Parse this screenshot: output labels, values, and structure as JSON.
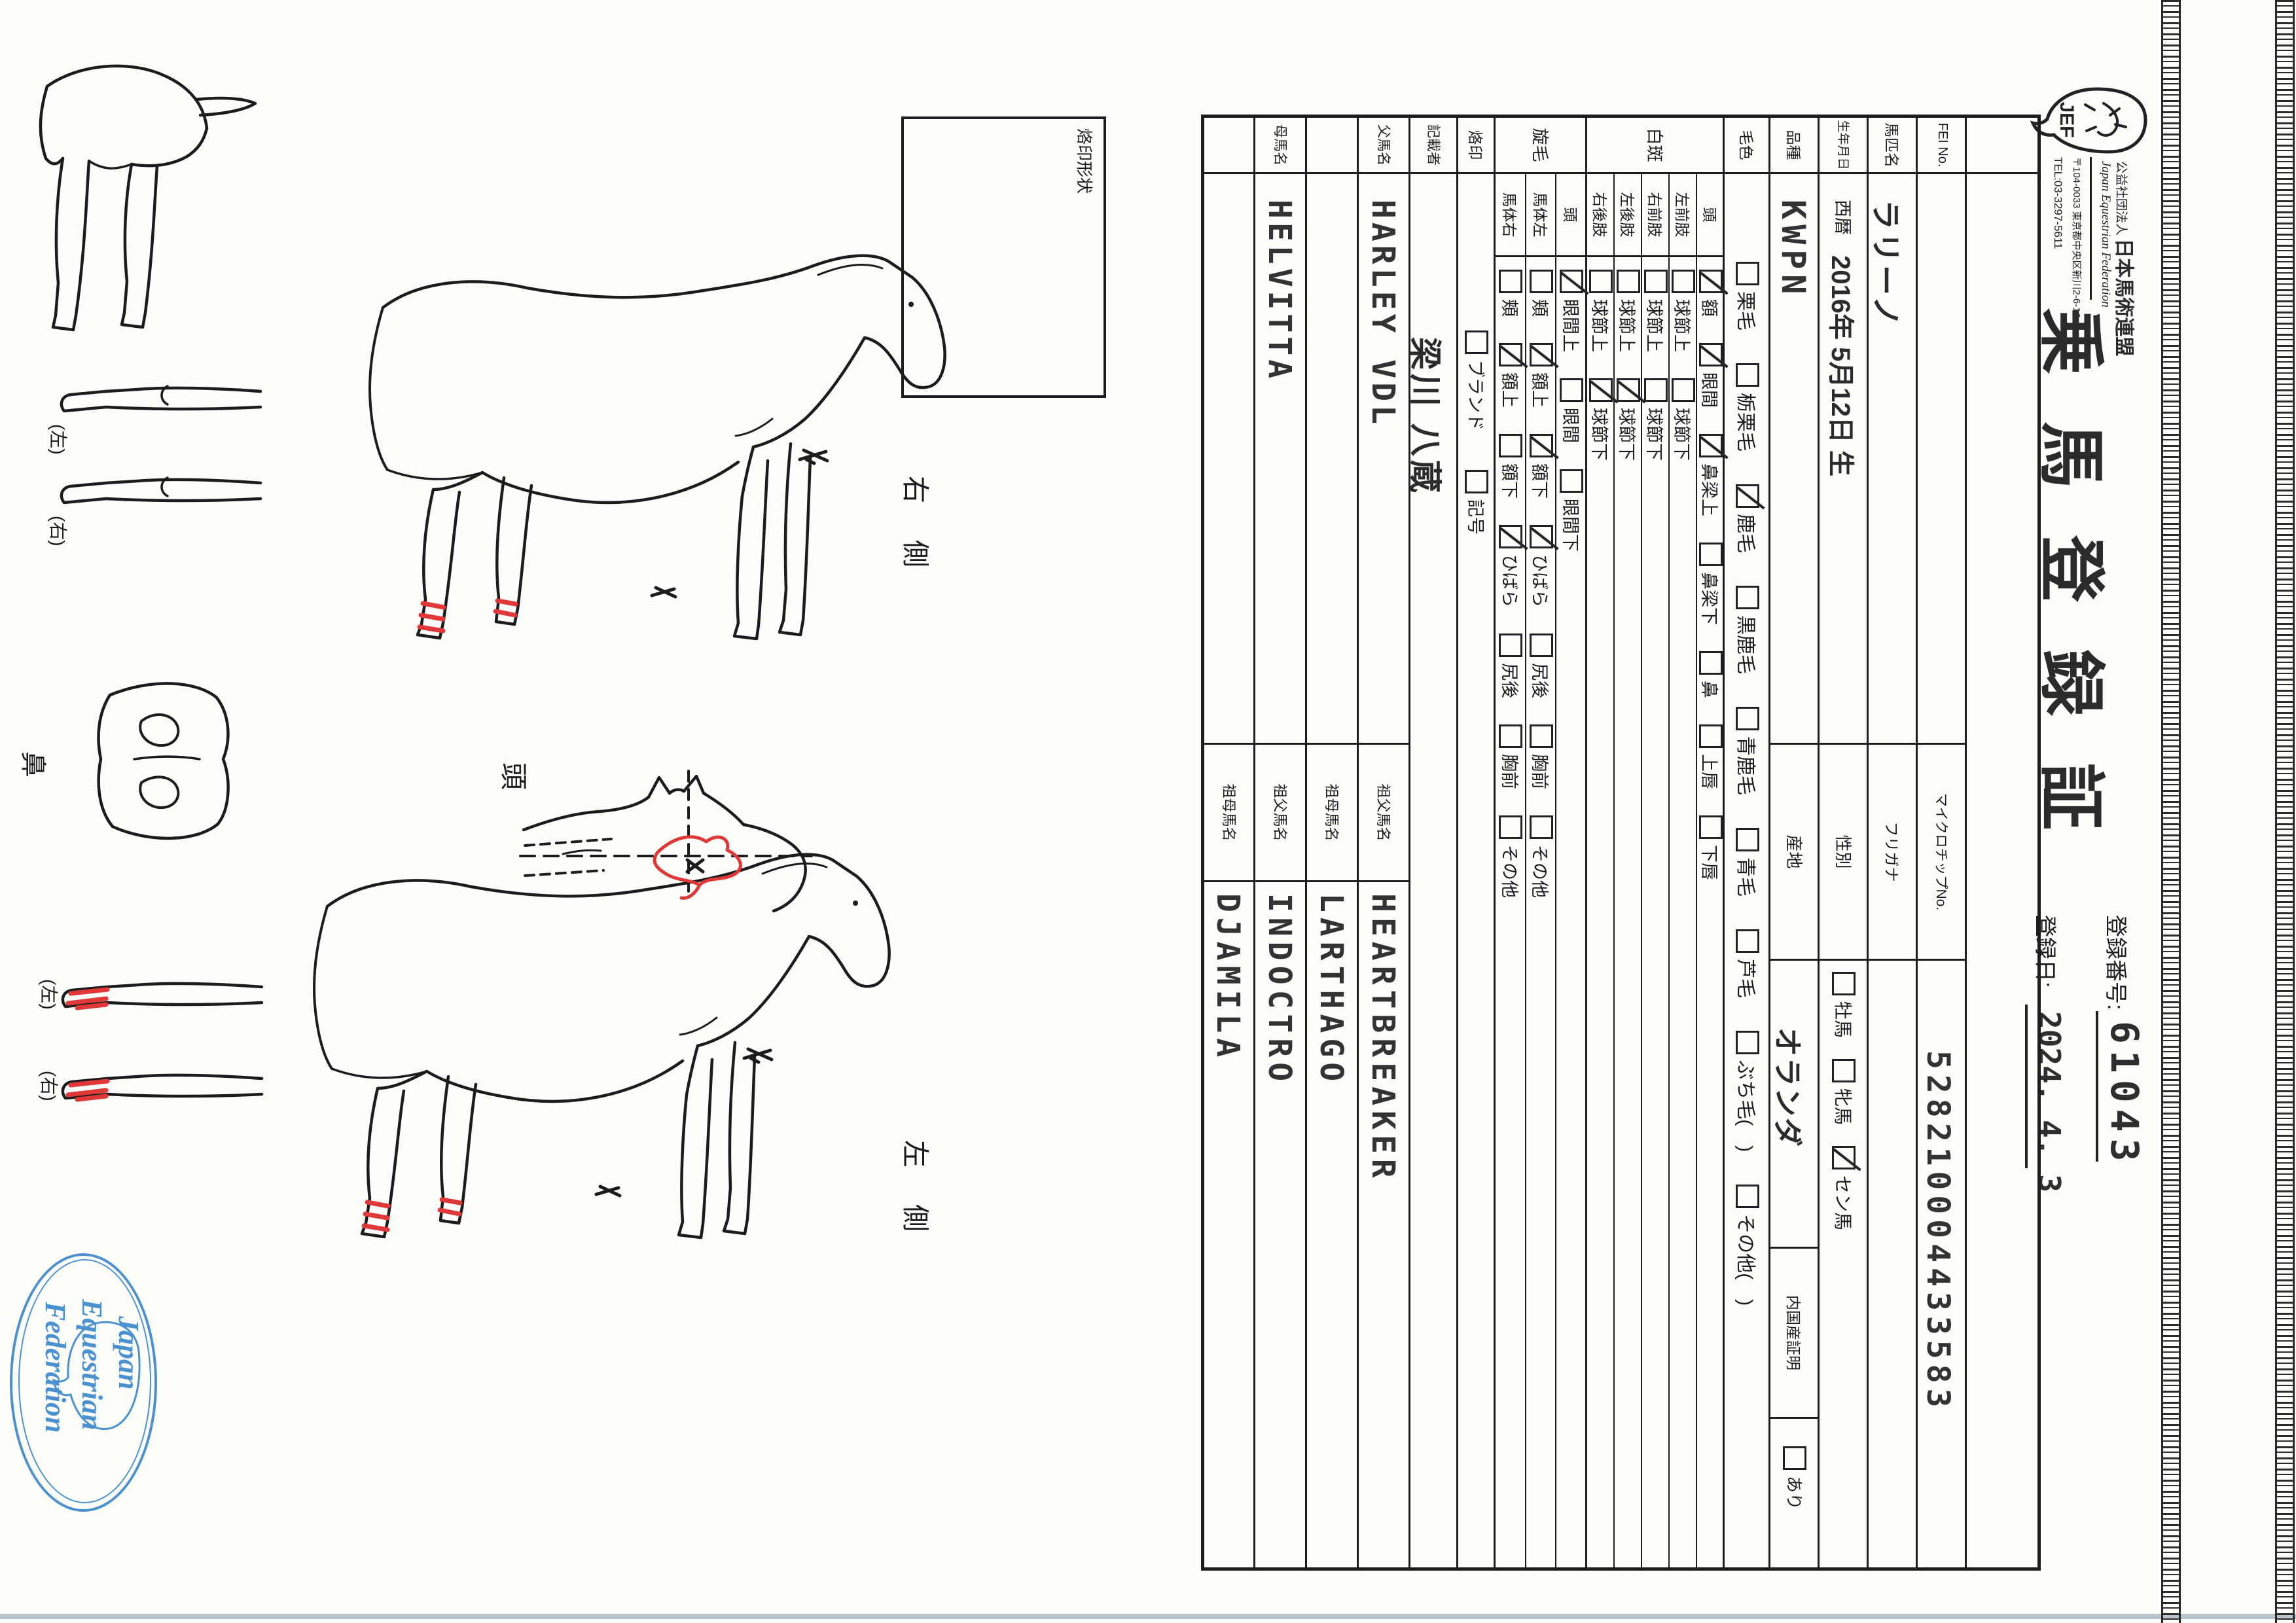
{
  "header": {
    "org_small": "公益社団法人",
    "org_name": "日本馬術連盟",
    "org_en": "Japan Equestrian Federation",
    "address": "〒104-0033 東京都中央区新川2-6-16",
    "tel": "TEL:03-3297-5611",
    "logo_text": "JEF",
    "title": "乗馬登録証",
    "reg_no_label": "登録番号:",
    "reg_no": "61043",
    "reg_date_label": "登録日:",
    "reg_date": "2024. 4. 3"
  },
  "table": {
    "fei_label": "FEI No.",
    "microchip_label": "マイクロチップNo.",
    "microchip": "528210004433583",
    "name_label": "馬匹名",
    "name": "ラリーノ",
    "furigana_label": "フリガナ",
    "birth_label": "生年月日",
    "birth_era": "西暦",
    "birth_date": "2016年 5月12日 生",
    "sex_label": "性別",
    "sex_options": [
      {
        "label": "牡馬",
        "checked": false
      },
      {
        "label": "牝馬",
        "checked": false
      },
      {
        "label": "セン馬",
        "checked": true
      }
    ],
    "breed_label": "品種",
    "breed": "KWPN",
    "origin_label": "産地",
    "origin": "オランダ",
    "domestic_label": "内国産証明",
    "domestic_options": [
      {
        "label": "あり",
        "checked": false
      }
    ],
    "coat_label": "毛色",
    "coat_options": [
      {
        "label": "栗毛",
        "checked": false
      },
      {
        "label": "栃栗毛",
        "checked": false
      },
      {
        "label": "鹿毛",
        "checked": true
      },
      {
        "label": "黒鹿毛",
        "checked": false
      },
      {
        "label": "青鹿毛",
        "checked": false
      },
      {
        "label": "青毛",
        "checked": false
      },
      {
        "label": "芦毛",
        "checked": false
      },
      {
        "label": "ぶち毛(　)",
        "checked": false
      },
      {
        "label": "その他(　)",
        "checked": false
      }
    ],
    "white_label": "白斑",
    "white_rows": [
      {
        "part": "頭",
        "items": [
          {
            "label": "額",
            "checked": true
          },
          {
            "label": "眼間",
            "checked": true
          },
          {
            "label": "鼻梁上",
            "checked": true
          },
          {
            "label": "鼻梁下",
            "checked": false
          },
          {
            "label": "鼻",
            "checked": false
          },
          {
            "label": "上唇",
            "checked": false
          },
          {
            "label": "下唇",
            "checked": false
          }
        ]
      },
      {
        "part": "左前肢",
        "items": [
          {
            "label": "球節上",
            "checked": false
          },
          {
            "label": "球節下",
            "checked": false
          }
        ]
      },
      {
        "part": "右前肢",
        "items": [
          {
            "label": "球節上",
            "checked": false
          },
          {
            "label": "球節下",
            "checked": false
          }
        ]
      },
      {
        "part": "左後肢",
        "items": [
          {
            "label": "球節上",
            "checked": false
          },
          {
            "label": "球節下",
            "checked": true
          }
        ]
      },
      {
        "part": "右後肢",
        "items": [
          {
            "label": "球節上",
            "checked": false
          },
          {
            "label": "球節下",
            "checked": true
          }
        ]
      }
    ],
    "whorl_label": "旋毛",
    "whorl_rows": [
      {
        "part": "頭",
        "items": [
          {
            "label": "眼間上",
            "checked": true
          },
          {
            "label": "眼間",
            "checked": false
          },
          {
            "label": "眼間下",
            "checked": false
          }
        ]
      },
      {
        "part": "馬体左",
        "items": [
          {
            "label": "頬",
            "checked": false
          },
          {
            "label": "額上",
            "checked": true
          },
          {
            "label": "額下",
            "checked": true
          },
          {
            "label": "ひばら",
            "checked": true
          },
          {
            "label": "尻後",
            "checked": false
          },
          {
            "label": "胸前",
            "checked": false
          },
          {
            "label": "その他",
            "checked": false
          }
        ]
      },
      {
        "part": "馬体右",
        "items": [
          {
            "label": "頬",
            "checked": false
          },
          {
            "label": "額上",
            "checked": true
          },
          {
            "label": "額下",
            "checked": false
          },
          {
            "label": "ひばら",
            "checked": true
          },
          {
            "label": "尻後",
            "checked": false
          },
          {
            "label": "胸前",
            "checked": false
          },
          {
            "label": "その他",
            "checked": false
          }
        ]
      }
    ],
    "brand_label": "烙印",
    "brand_options": [
      {
        "label": "ブランド",
        "checked": false
      },
      {
        "label": "記号",
        "checked": false
      }
    ],
    "recorder_label": "記載者",
    "recorder": "梁川 八蔵",
    "sire_label": "父馬名",
    "sire": "HARLEY VDL",
    "sire_sire_label": "祖父馬名",
    "sire_sire": "HEARTBREAKER",
    "sire_dam_label": "祖母馬名",
    "sire_dam": "LARTHAGO",
    "dam_label": "母馬名",
    "dam": "HELVITTA",
    "dam_sire_label": "祖父馬名",
    "dam_sire": "INDOCTRO",
    "dam_dam_label": "祖母馬名",
    "dam_dam": "DJAMILA"
  },
  "diagram": {
    "brand_box_label": "烙印形状",
    "right_side_label": "右側",
    "left_side_label": "左側",
    "head_label": "頭",
    "nose_label": "鼻",
    "leg_left_label": "(左)",
    "leg_right_label": "(右)"
  },
  "stamp": {
    "line1": "Japan",
    "line2": "Equestrian",
    "line3": "Federation"
  }
}
